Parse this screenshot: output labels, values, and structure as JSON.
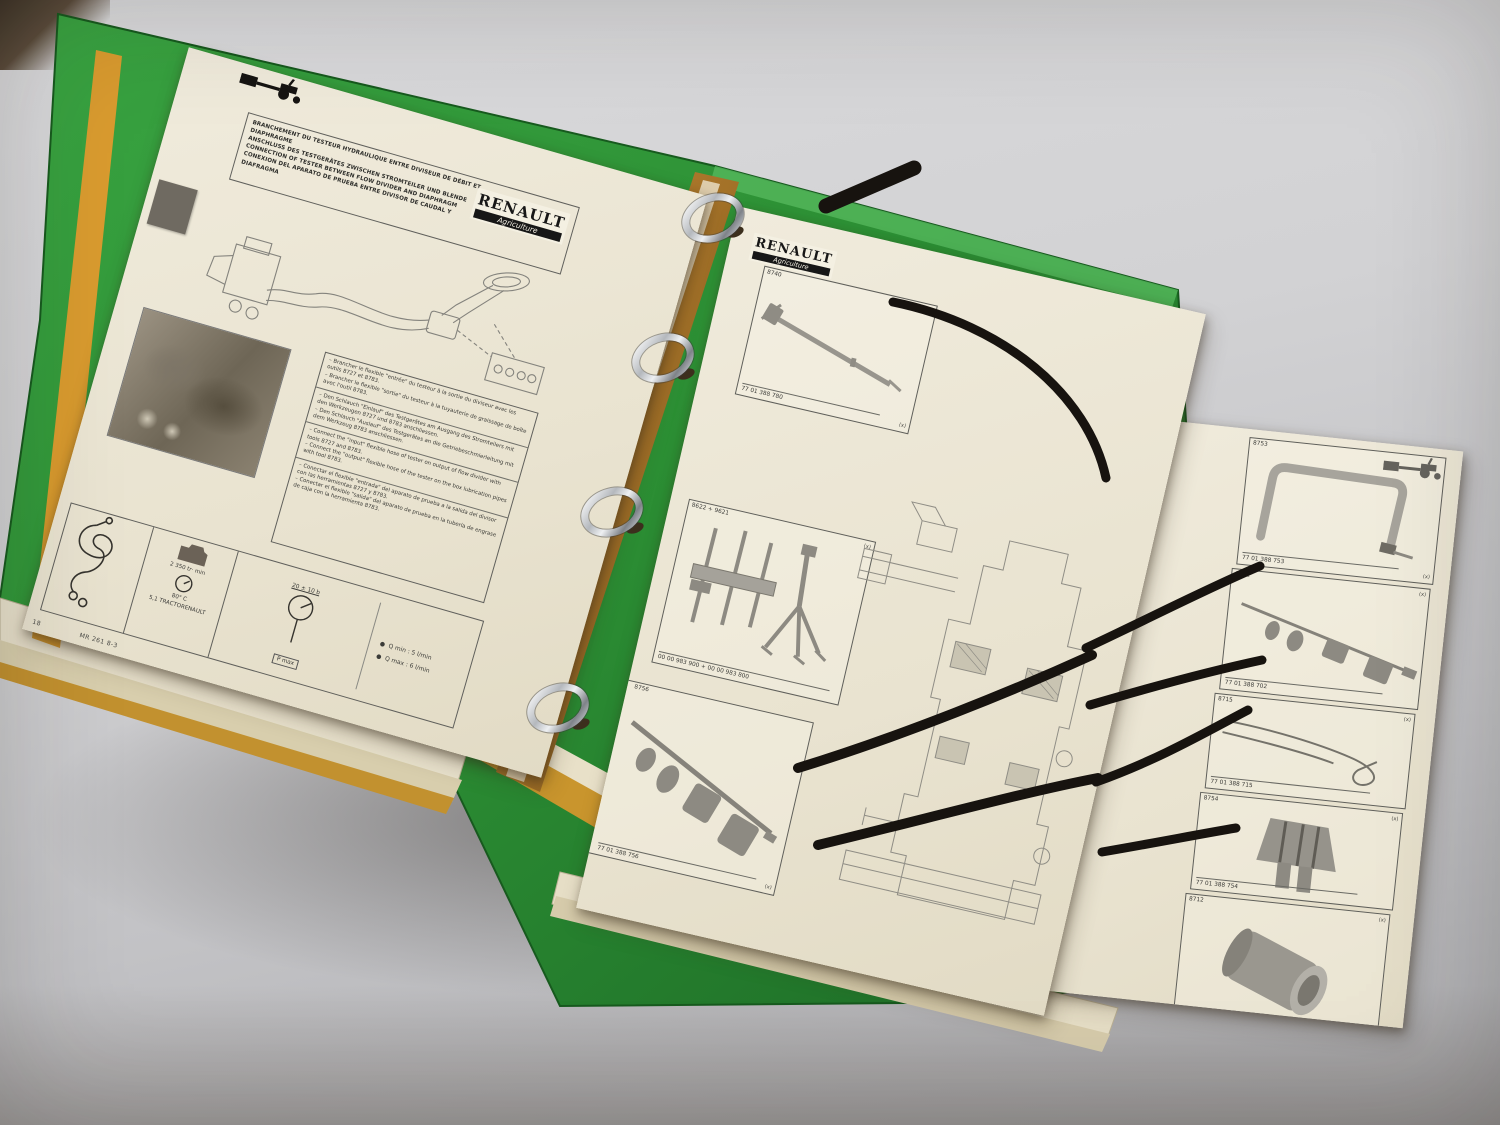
{
  "scene": {
    "backdrop_color": "#cdced0",
    "binder_color": "#2f9b37",
    "divider_color": "#cf9a2e"
  },
  "brand": {
    "name": "RENAULT",
    "division": "Agriculture"
  },
  "left_page": {
    "header": {
      "title_fr": "BRANCHEMENT DU TESTEUR HYDRAULIQUE ENTRE DIVISEUR DE DÉBIT ET DIAPHRAGME",
      "title_de": "ANSCHLUSS DES TESTGERÄTES ZWISCHEN STROMTEILER UND BLENDE",
      "title_en": "CONNECTION OF TESTER BETWEEN FLOW DIVIDER AND DIAPHRAGM",
      "title_es": "CONEXION DEL APARATO DE PRUEBA ENTRE DIVISOR DE CAUDAL Y DIAFRAGMA"
    },
    "instructions": {
      "fr": "– Brancher le flexible \"entrée\" du testeur à la sortie du diviseur avec les outils 8727 et 8783.\n– Brancher le flexible \"sortie\" du testeur à la tuyauterie de graissage de boîte avec l'outil 8783.",
      "de": "– Den Schlauch \"Einlauf\" des Testgerätes am Ausgang des Stromteilers mit den Werkzeugen 8727 und 8783 anschliessen.\n– Den Schlauch \"Auslauf\" des Testgerätes an die Getriebeschmierleitung mit dem Werkzeug 8783 anschliessen.",
      "en": "– Connect the \"input\" flexible hose of tester on output of flow divider with tools 8727 and 8783.\n– Connect the \"output\" flexible hose of the tester on the box lubrication pipes with tool 8783.",
      "es": "– Conectar el flexible \"entrada\" del aparato de prueba a la salida del divisor con las herramientas 8727 y 8783.\n– Conectar el flexible \"salida\" del aparato de prueba en la tubería de engrase de caja con la herramienta 8783."
    },
    "spec_panel": {
      "rpm": "2 350 tr· min",
      "temp": "80° C",
      "oil": "5,1 TRACTORENAULT",
      "pressure": "20 ± 10 b",
      "pmax": "P max",
      "q_min": "Q min : 5 l/min",
      "q_max": "Q max : 6 l/min"
    },
    "footer": {
      "page_number": "18",
      "ref": "MR 261 8-3"
    }
  },
  "right_page": {
    "tool_boxes": [
      {
        "id": "8740",
        "part_number": "77 01 388 780",
        "qty": "(x)"
      },
      {
        "id": "8622 + 9621",
        "part_number": "00 00 983 900 + 00 00 983 800",
        "qty": "(x)"
      },
      {
        "id": "8756",
        "part_number": "77 01 388 756",
        "qty": "(x)"
      }
    ]
  },
  "far_right_page": {
    "tool_boxes": [
      {
        "id": "8753",
        "part_number": "77 01 388 753",
        "qty": "(x)"
      },
      {
        "id": "8702",
        "part_number": "77 01 388 702",
        "qty": "(x)"
      },
      {
        "id": "8715",
        "part_number": "77 01 388 715",
        "qty": "(x)"
      },
      {
        "id": "8754",
        "part_number": "77 01 388 754",
        "qty": "(x)"
      },
      {
        "id": "8712",
        "part_number": "77 01 388 752",
        "qty": "(x)"
      }
    ],
    "footer": {
      "ref": "MR 261 8-3",
      "page_number": "19"
    }
  }
}
